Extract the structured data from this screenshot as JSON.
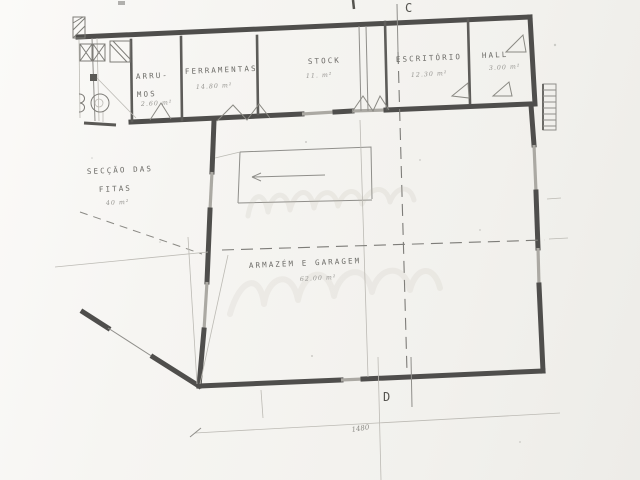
{
  "plan": {
    "markers": {
      "top": "C",
      "bottom": "D"
    },
    "rooms": {
      "arrumos": {
        "line1": "ARRU-",
        "line2": "MOS",
        "area": "2.60 m²"
      },
      "ferramentas": {
        "label": "FERRAMENTAS",
        "area": "14.80 m²"
      },
      "stock": {
        "label": "STOCK",
        "area": "11. m²"
      },
      "escritorio": {
        "label": "ESCRITÓRIO",
        "area": "12.30 m²"
      },
      "hall": {
        "label": "HALL",
        "area": "3.00 m²"
      },
      "seccao_fitas": {
        "line1": "SECÇÃO DAS",
        "line2": "FITAS",
        "area": "40 m²"
      },
      "armazem": {
        "label": "ARMAZÉM E GARAGEM",
        "area": "62.00 m²"
      }
    },
    "dimension": {
      "value": "1480"
    }
  },
  "colors": {
    "paper": "#f5f4f1",
    "wall_ink": "#4f4e4c",
    "thin_line": "#8f8e8a",
    "label_ink": "#6c6b67",
    "watermark": "#b7b2a6"
  }
}
